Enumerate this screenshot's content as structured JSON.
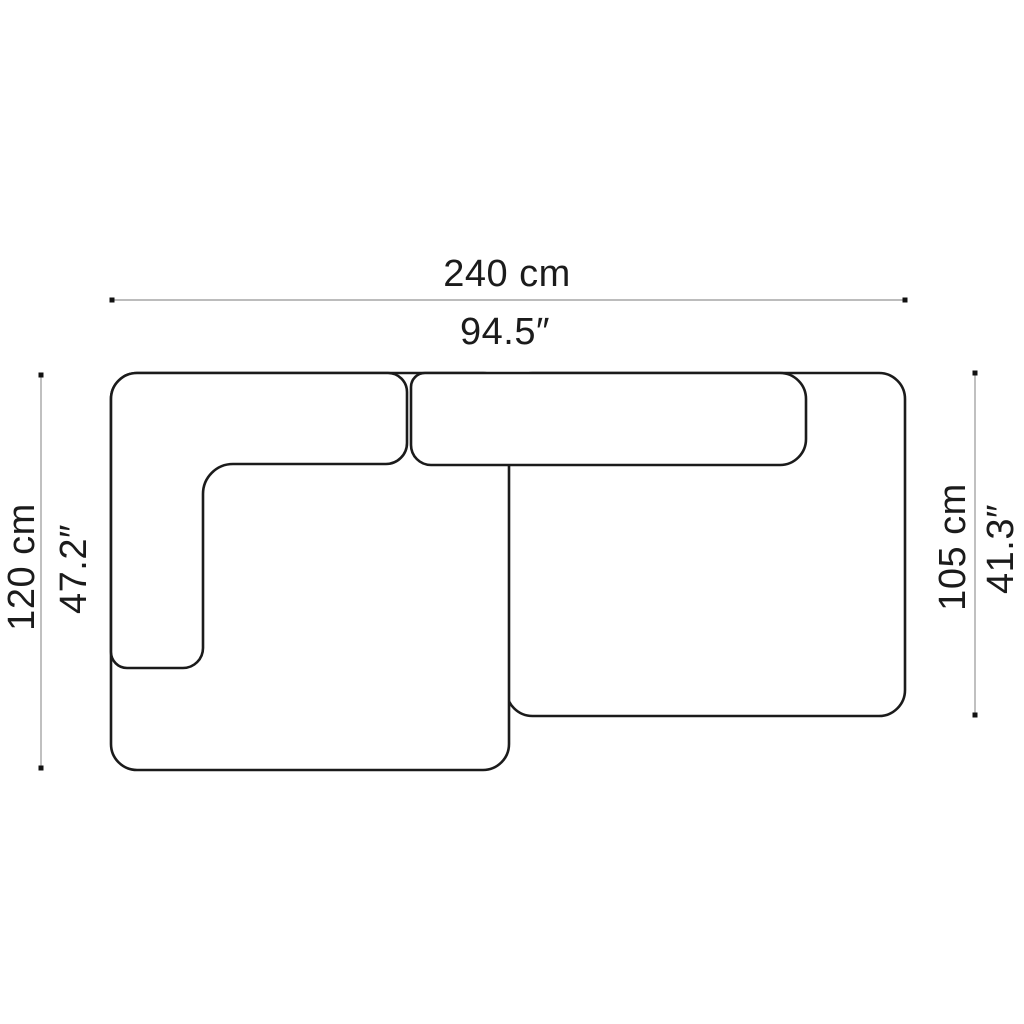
{
  "colors": {
    "background": "#ffffff",
    "outline": "#1b1b1b",
    "dimension_line": "#a6a6a6",
    "marker": "#111111",
    "text": "#1b1b1b"
  },
  "dimensions": {
    "width": {
      "metric": "240 cm",
      "imperial": "94.5″"
    },
    "depth_left": {
      "metric": "120 cm",
      "imperial": "47.2″"
    },
    "depth_right": {
      "metric": "105 cm",
      "imperial": "41.3″"
    }
  }
}
